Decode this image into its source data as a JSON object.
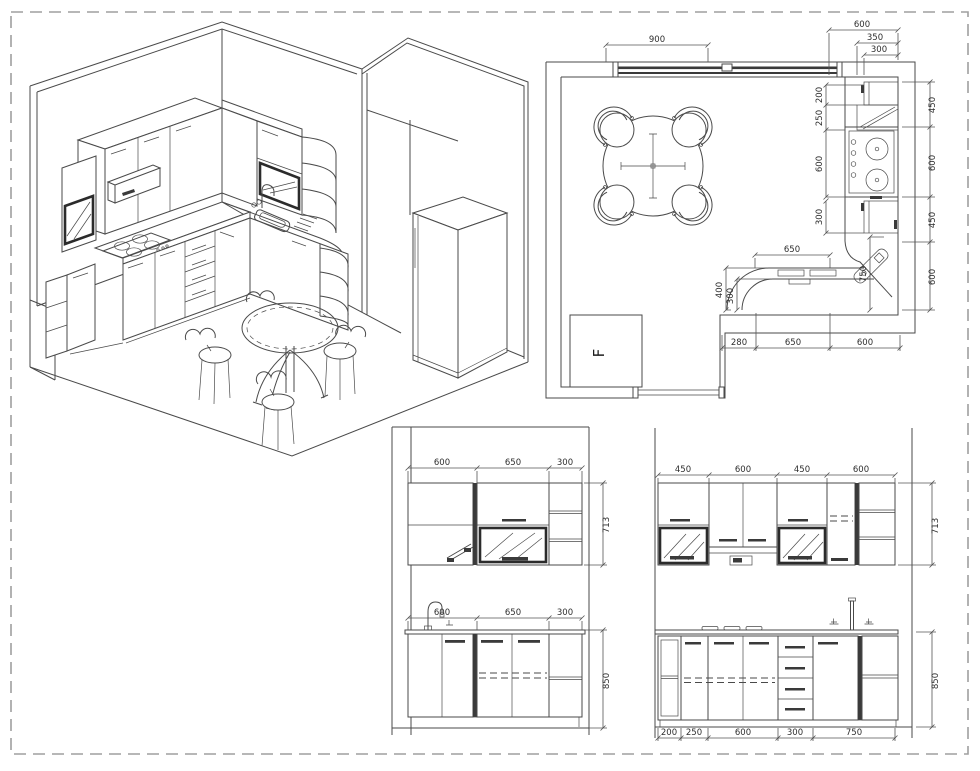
{
  "sheet": {
    "background": "#ffffff",
    "border_color": "#9f9f9f",
    "line_color": "#4a4a4a",
    "dim_text_color": "#2e2e2e"
  },
  "floor_plan": {
    "window_width": "900",
    "depth_dims": {
      "counter": "600",
      "hood": "350",
      "wall_cabinet": "300"
    },
    "left_chain": [
      "200",
      "250",
      "600",
      "300"
    ],
    "corner_width": "750",
    "right_chain": [
      "450",
      "600",
      "450",
      "600"
    ],
    "counter_width": "650",
    "curve_radii": [
      "400",
      "300"
    ],
    "bottom_chain": [
      "280",
      "650",
      "600"
    ],
    "fridge_label": "F"
  },
  "elevation_front": {
    "upper_widths": [
      "600",
      "650",
      "300"
    ],
    "upper_height": "713",
    "base_widths": [
      "600",
      "650",
      "300"
    ],
    "base_height": "850"
  },
  "elevation_side": {
    "upper_widths": [
      "450",
      "600",
      "450",
      "600"
    ],
    "upper_height": "713",
    "base_widths": [
      "200",
      "250",
      "600",
      "300",
      "750"
    ],
    "base_height": "850"
  }
}
